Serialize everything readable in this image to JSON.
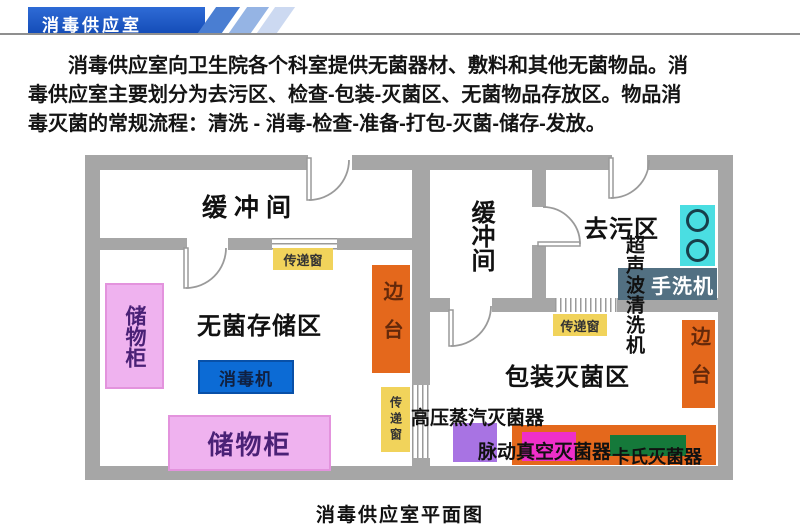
{
  "banner": {
    "title": "消毒供应室"
  },
  "intro": {
    "line1": "消毒供应室向卫生院各个科室提供无菌器材、敷料和其他无菌物品。消",
    "line2": "毒供应室主要划分为去污区、检查-包装-灭菌区、无菌物品存放区。物品消",
    "line3": "毒灭菌的常规流程：清洗 - 消毒-检查-准备-打包-灭菌-储存-发放。"
  },
  "plan": {
    "caption": "消毒供应室平面图",
    "rooms": {
      "buffer_left": "缓冲间",
      "buffer_right": "缓冲间",
      "sterile_storage": "无菌存储区",
      "decontamination": "去污区",
      "packaging_sterilization": "包装灭菌区"
    },
    "labels": {
      "cabinet_left": "储物柜",
      "cabinet_bottom": "储物柜",
      "disinfector": "消毒机",
      "side_table_left": "边台",
      "side_table_right": "边台",
      "pass_window_top": "传递窗",
      "pass_window_mid": "传递窗",
      "pass_window_right": "传递窗",
      "ultrasonic_cleaner": "超声波清洗机",
      "hand_washer": "手洗机",
      "autoclave": "高压蒸汽灭菌器",
      "pulse_vacuum_sterilizer": "脉动真空灭菌器",
      "cassette_sterilizer": "卡氏灭菌器"
    },
    "colors": {
      "wall_gray": "#a6a6a6",
      "banner_blue": "#1b59cd",
      "pass_window_yellow": "#f1d35b",
      "side_table_orange": "#e4681c",
      "cabinet_pink": "#efb2ef",
      "disinfector_blue": "#0c6bd5",
      "sink_cyan": "#4adee2",
      "hand_washer_slate": "#527082",
      "autoclave_purple": "#a873e3",
      "pulse_vacuum_magenta": "#ef2fc9",
      "cassette_green": "#15793a"
    }
  }
}
